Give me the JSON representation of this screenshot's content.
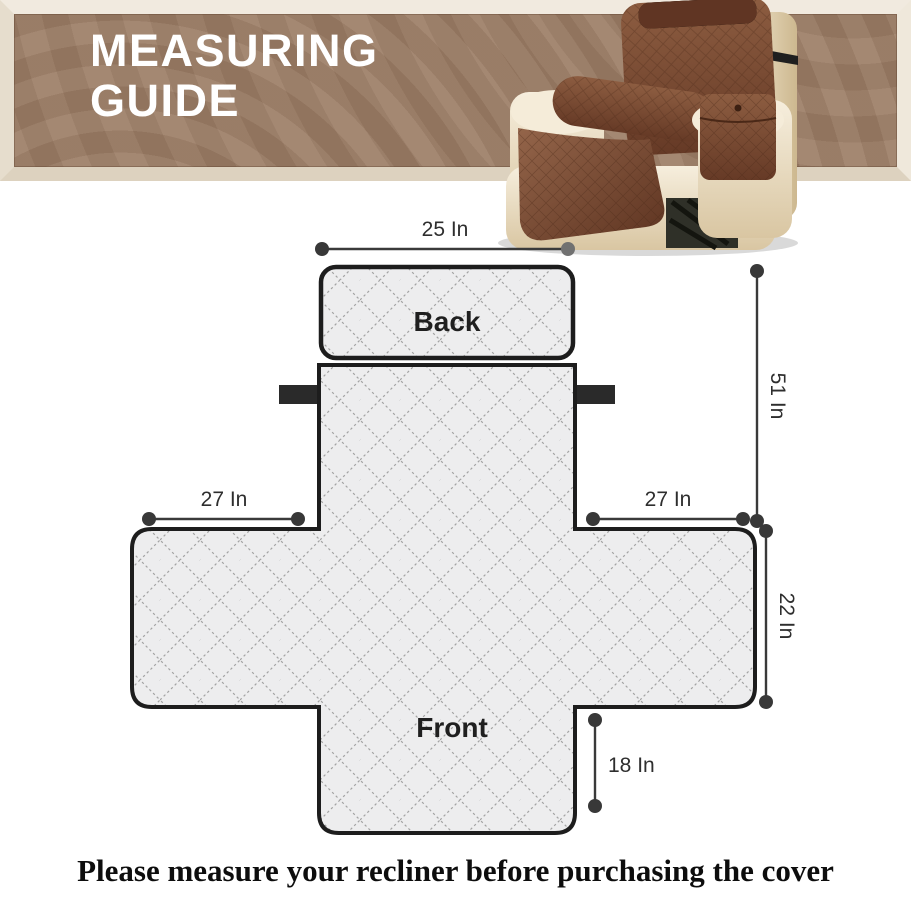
{
  "banner": {
    "title_line1": "MEASURING",
    "title_line2": "GUIDE",
    "background_color": "#9b7c64",
    "frame_color": "#e8dfd1",
    "text_color": "#ffffff"
  },
  "photo": {
    "name": "recliner-with-brown-quilted-cover",
    "chair_color": "#ecdfc3",
    "cover_color": "#7b4a33",
    "strap_color": "#1f1f1f"
  },
  "diagram": {
    "back_label": "Back",
    "front_label": "Front",
    "outline_color": "#1d1d1d",
    "quilt_background": "#ededee",
    "quilt_line_color": "#a3a3a3",
    "dimension_color": "#3a3a3a",
    "measurements": {
      "back_width": {
        "label": "25 In",
        "value_in": 25
      },
      "cover_length": {
        "label": "51 In",
        "value_in": 51
      },
      "left_arm": {
        "label": "27 In",
        "value_in": 27
      },
      "right_arm": {
        "label": "27 In",
        "value_in": 27
      },
      "seat_side": {
        "label": "22 In",
        "value_in": 22
      },
      "front_drop": {
        "label": "18 In",
        "value_in": 18
      }
    }
  },
  "footer": {
    "text": "Please measure your recliner before purchasing the cover"
  }
}
